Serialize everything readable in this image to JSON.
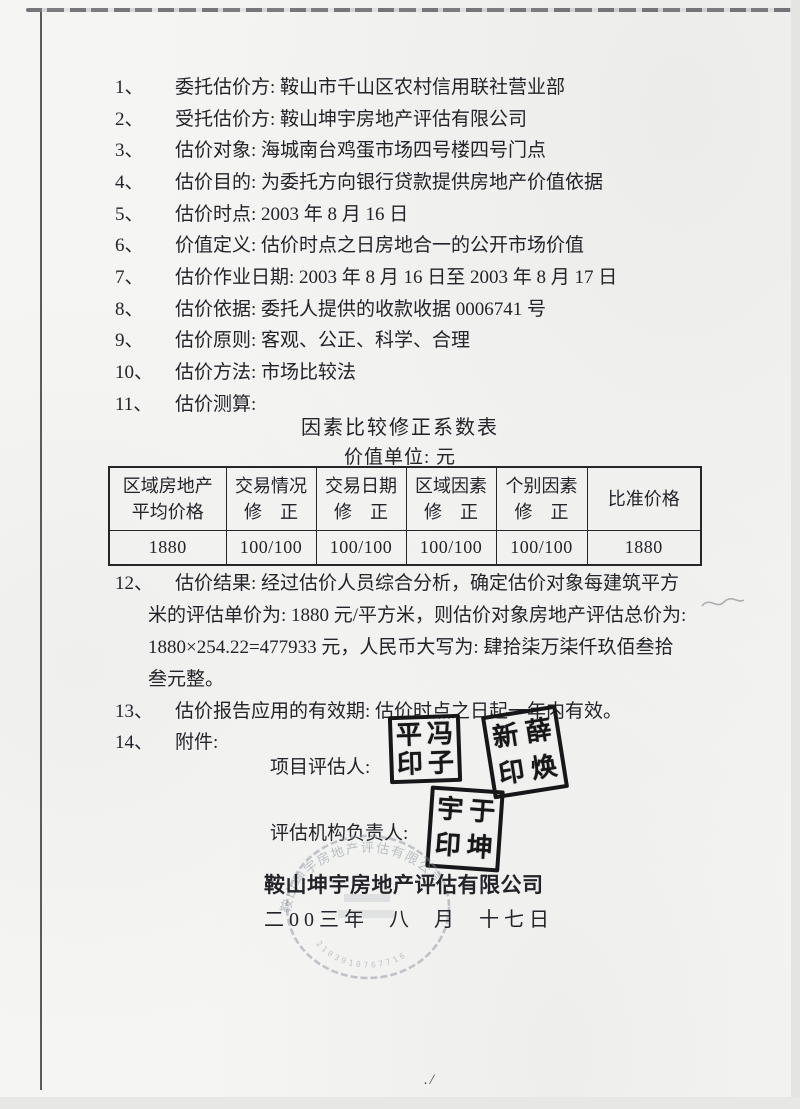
{
  "doc": {
    "items": [
      {
        "num": "1、",
        "text": "委托估价方: 鞍山市千山区农村信用联社营业部"
      },
      {
        "num": "2、",
        "text": "受托估价方: 鞍山坤宇房地产评估有限公司"
      },
      {
        "num": "3、",
        "text": "估价对象: 海城南台鸡蛋市场四号楼四号门点"
      },
      {
        "num": "4、",
        "text": "估价目的: 为委托方向银行贷款提供房地产价值依据"
      },
      {
        "num": "5、",
        "text": "估价时点: 2003 年 8 月 16 日"
      },
      {
        "num": "6、",
        "text": "价值定义: 估价时点之日房地合一的公开市场价值"
      },
      {
        "num": "7、",
        "text": "估价作业日期: 2003 年 8 月 16 日至 2003 年 8 月 17 日"
      },
      {
        "num": "8、",
        "text": "估价依据: 委托人提供的收款收据 0006741 号"
      },
      {
        "num": "9、",
        "text": "估价原则: 客观、公正、科学、合理"
      },
      {
        "num": "10、",
        "text": "估价方法: 市场比较法"
      },
      {
        "num": "11、",
        "text": "估价测算:"
      }
    ],
    "table": {
      "title": "因素比较修正系数表",
      "unit_line": "价值单位: 元",
      "headers": [
        {
          "l1": "区域房地产",
          "l2": "平均价格"
        },
        {
          "l1": "交易情况",
          "l2": "修　正"
        },
        {
          "l1": "交易日期",
          "l2": "修　正"
        },
        {
          "l1": "区域因素",
          "l2": "修　正"
        },
        {
          "l1": "个别因素",
          "l2": "修　正"
        },
        {
          "l1": "比准价格",
          "l2": ""
        }
      ],
      "row": [
        "1880",
        "100/100",
        "100/100",
        "100/100",
        "100/100",
        "1880"
      ]
    },
    "item12": {
      "num": "12、",
      "lines": [
        "估价结果: 经过估价人员综合分析，确定估价对象每建筑平方",
        "米的评估单价为: 1880 元/平方米，则估价对象房地产评估总价为:",
        "1880×254.22=477933 元，人民币大写为: 肆拾柒万柒仟玖佰叁拾",
        "叁元整。"
      ]
    },
    "item13": {
      "num": "13、",
      "text": "估价报告应用的有效期: 估价时点之日起一年内有效。"
    },
    "item14": {
      "num": "14、",
      "text": "附件:"
    },
    "signatures": {
      "project_label": "项目评估人:",
      "org_label": "评估机构负责人:",
      "stamps": [
        {
          "c0": "平",
          "c1": "冯",
          "c2": "印",
          "c3": "子"
        },
        {
          "c0": "新",
          "c1": "薛",
          "c2": "印",
          "c3": "焕"
        },
        {
          "c0": "宇",
          "c1": "于",
          "c2": "印",
          "c3": "坤"
        }
      ],
      "company": "鞍山坤宇房地产评估有限公司",
      "date": "二00三年  八  月  十七日"
    },
    "seal": {
      "arc_text": "鞍山坤宇房地产评估有限公司",
      "digits": "2103910767716"
    },
    "footer_mark": "./"
  },
  "colors": {
    "ink": "#23232a",
    "stamp_ink": "#17171a",
    "seal_gray": "#7f8a98",
    "paper": "#f5f5f3"
  }
}
